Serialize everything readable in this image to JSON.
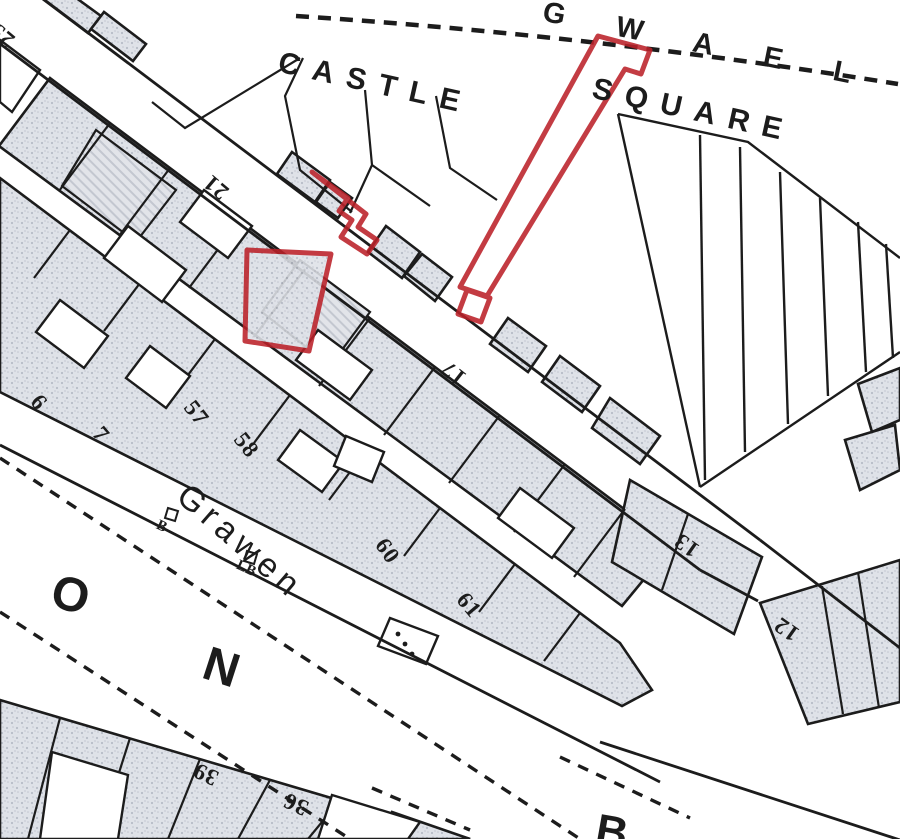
{
  "map": {
    "streets": {
      "gwaelod": "G W A E L O",
      "castle": "CASTLE",
      "square": "SQUARE",
      "grawen": "Grawen",
      "big_o": "O",
      "big_n": "N",
      "partial_bottom": "B"
    },
    "map_symbols": {
      "post_b": "B",
      "letter_box": "LB"
    },
    "plot_numbers": [
      {
        "label": "25"
      },
      {
        "label": "21"
      },
      {
        "label": "17"
      },
      {
        "label": "13"
      },
      {
        "label": "12"
      },
      {
        "label": "6"
      },
      {
        "label": "7"
      },
      {
        "label": "57"
      },
      {
        "label": "58"
      },
      {
        "label": "60"
      },
      {
        "label": "61"
      },
      {
        "label": "39"
      },
      {
        "label": "36"
      }
    ],
    "colors": {
      "highlight_outline": "#bb2129",
      "map_ink": "#1c1c1c",
      "building_fill": "#dfe2e8",
      "paper": "#ffffff"
    }
  }
}
